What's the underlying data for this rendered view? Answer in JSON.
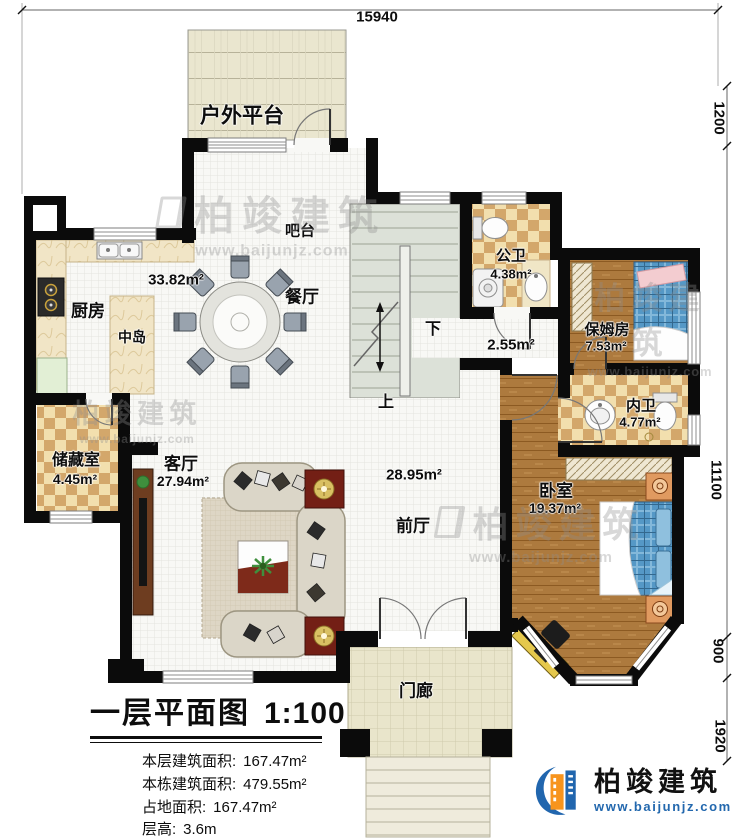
{
  "plan": {
    "dimensions": {
      "top": "15940",
      "right_top": "1200",
      "right_main": "11100",
      "right_lower": "900",
      "right_bottom": "1920"
    },
    "rooms": {
      "outdoor_platform": {
        "name": "户外平台"
      },
      "bar": {
        "name": "吧台"
      },
      "open_area": {
        "area": "33.82m²"
      },
      "dining": {
        "name": "餐厅"
      },
      "kitchen": {
        "name": "厨房"
      },
      "island": {
        "name": "中岛"
      },
      "public_bath": {
        "name": "公卫",
        "area": "4.38m²"
      },
      "hall": {
        "area": "2.55m²"
      },
      "nanny_room": {
        "name": "保姆房",
        "area": "7.53m²"
      },
      "inner_bath": {
        "name": "内卫",
        "area": "4.77m²"
      },
      "bedroom": {
        "name": "卧室",
        "area": "19.37m²"
      },
      "storage": {
        "name": "储藏室",
        "area": "4.45m²"
      },
      "living": {
        "name": "客厅",
        "area": "27.94m²"
      },
      "foyer": {
        "name": "前厅",
        "area": "28.95m²"
      },
      "porch": {
        "name": "门廊"
      },
      "stair_down": "下",
      "stair_up": "上"
    }
  },
  "title_block": {
    "title": "一层平面图",
    "scale": "1:100",
    "items": [
      {
        "label": "本层建筑面积:",
        "value": "167.47m²"
      },
      {
        "label": "本栋建筑面积:",
        "value": "479.55m²"
      },
      {
        "label": "占地面积:",
        "value": "167.47m²"
      },
      {
        "label": "层高:",
        "value": "3.6m"
      }
    ]
  },
  "branding": {
    "company": "柏竣建筑",
    "website": "www.baijunjz.com"
  },
  "watermark": {
    "text": "柏竣建筑",
    "website": "www.baijunjz.com"
  }
}
